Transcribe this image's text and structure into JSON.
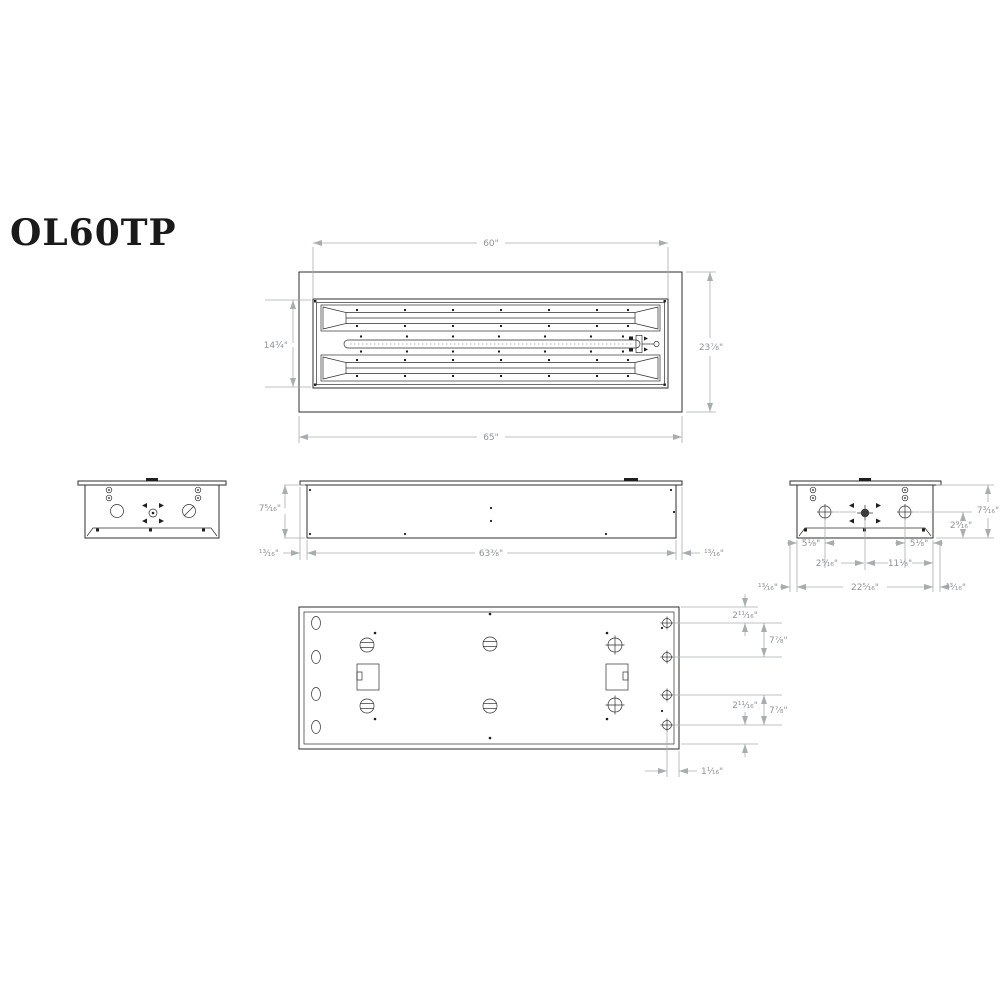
{
  "title": "OL60TP",
  "colors": {
    "object_line": "#2e2e2e",
    "dimension_line": "#a8adb0",
    "dimension_text": "#8e9397",
    "background": "#ffffff"
  },
  "views": {
    "top": {
      "label": "top view",
      "dims": {
        "inner_width": "60\"",
        "overall_width": "65\"",
        "opening_height": "14¾\"",
        "overall_depth": "23⅞\""
      }
    },
    "side": {
      "label": "side view",
      "dims": {
        "body_height": "7⁵⁄₁₆\"",
        "body_length": "63⅜\"",
        "flange_overhang_left": "¹³⁄₁₆\"",
        "flange_overhang_right": "¹³⁄₁₆\""
      }
    },
    "end": {
      "label": "end view",
      "dims": {
        "body_height": "7³⁄₁₆\"",
        "hole_to_bottom": "2⁹⁄₁₆\"",
        "edge_to_hole_left": "5⅛\"",
        "edge_to_hole_right": "5⅛\"",
        "center_offset": "2⁵⁄₁₆\"",
        "center_to_edge": "11⅛\"",
        "body_width": "22⁵⁄₁₆\"",
        "flange_overhang_left": "¹³⁄₁₆\"",
        "flange_overhang_right": "¹³⁄₁₆\""
      }
    },
    "bottom": {
      "label": "bottom view",
      "dims": {
        "edge_to_hole_top": "2¹¹⁄₁₆\"",
        "hole_spacing_upper": "7⅞\"",
        "hole_spacing_lower": "7⅞\"",
        "edge_to_hole_bottom": "2¹¹⁄₁₆\"",
        "hole_to_edge_offset": "1¹⁄₁₆\""
      }
    }
  }
}
